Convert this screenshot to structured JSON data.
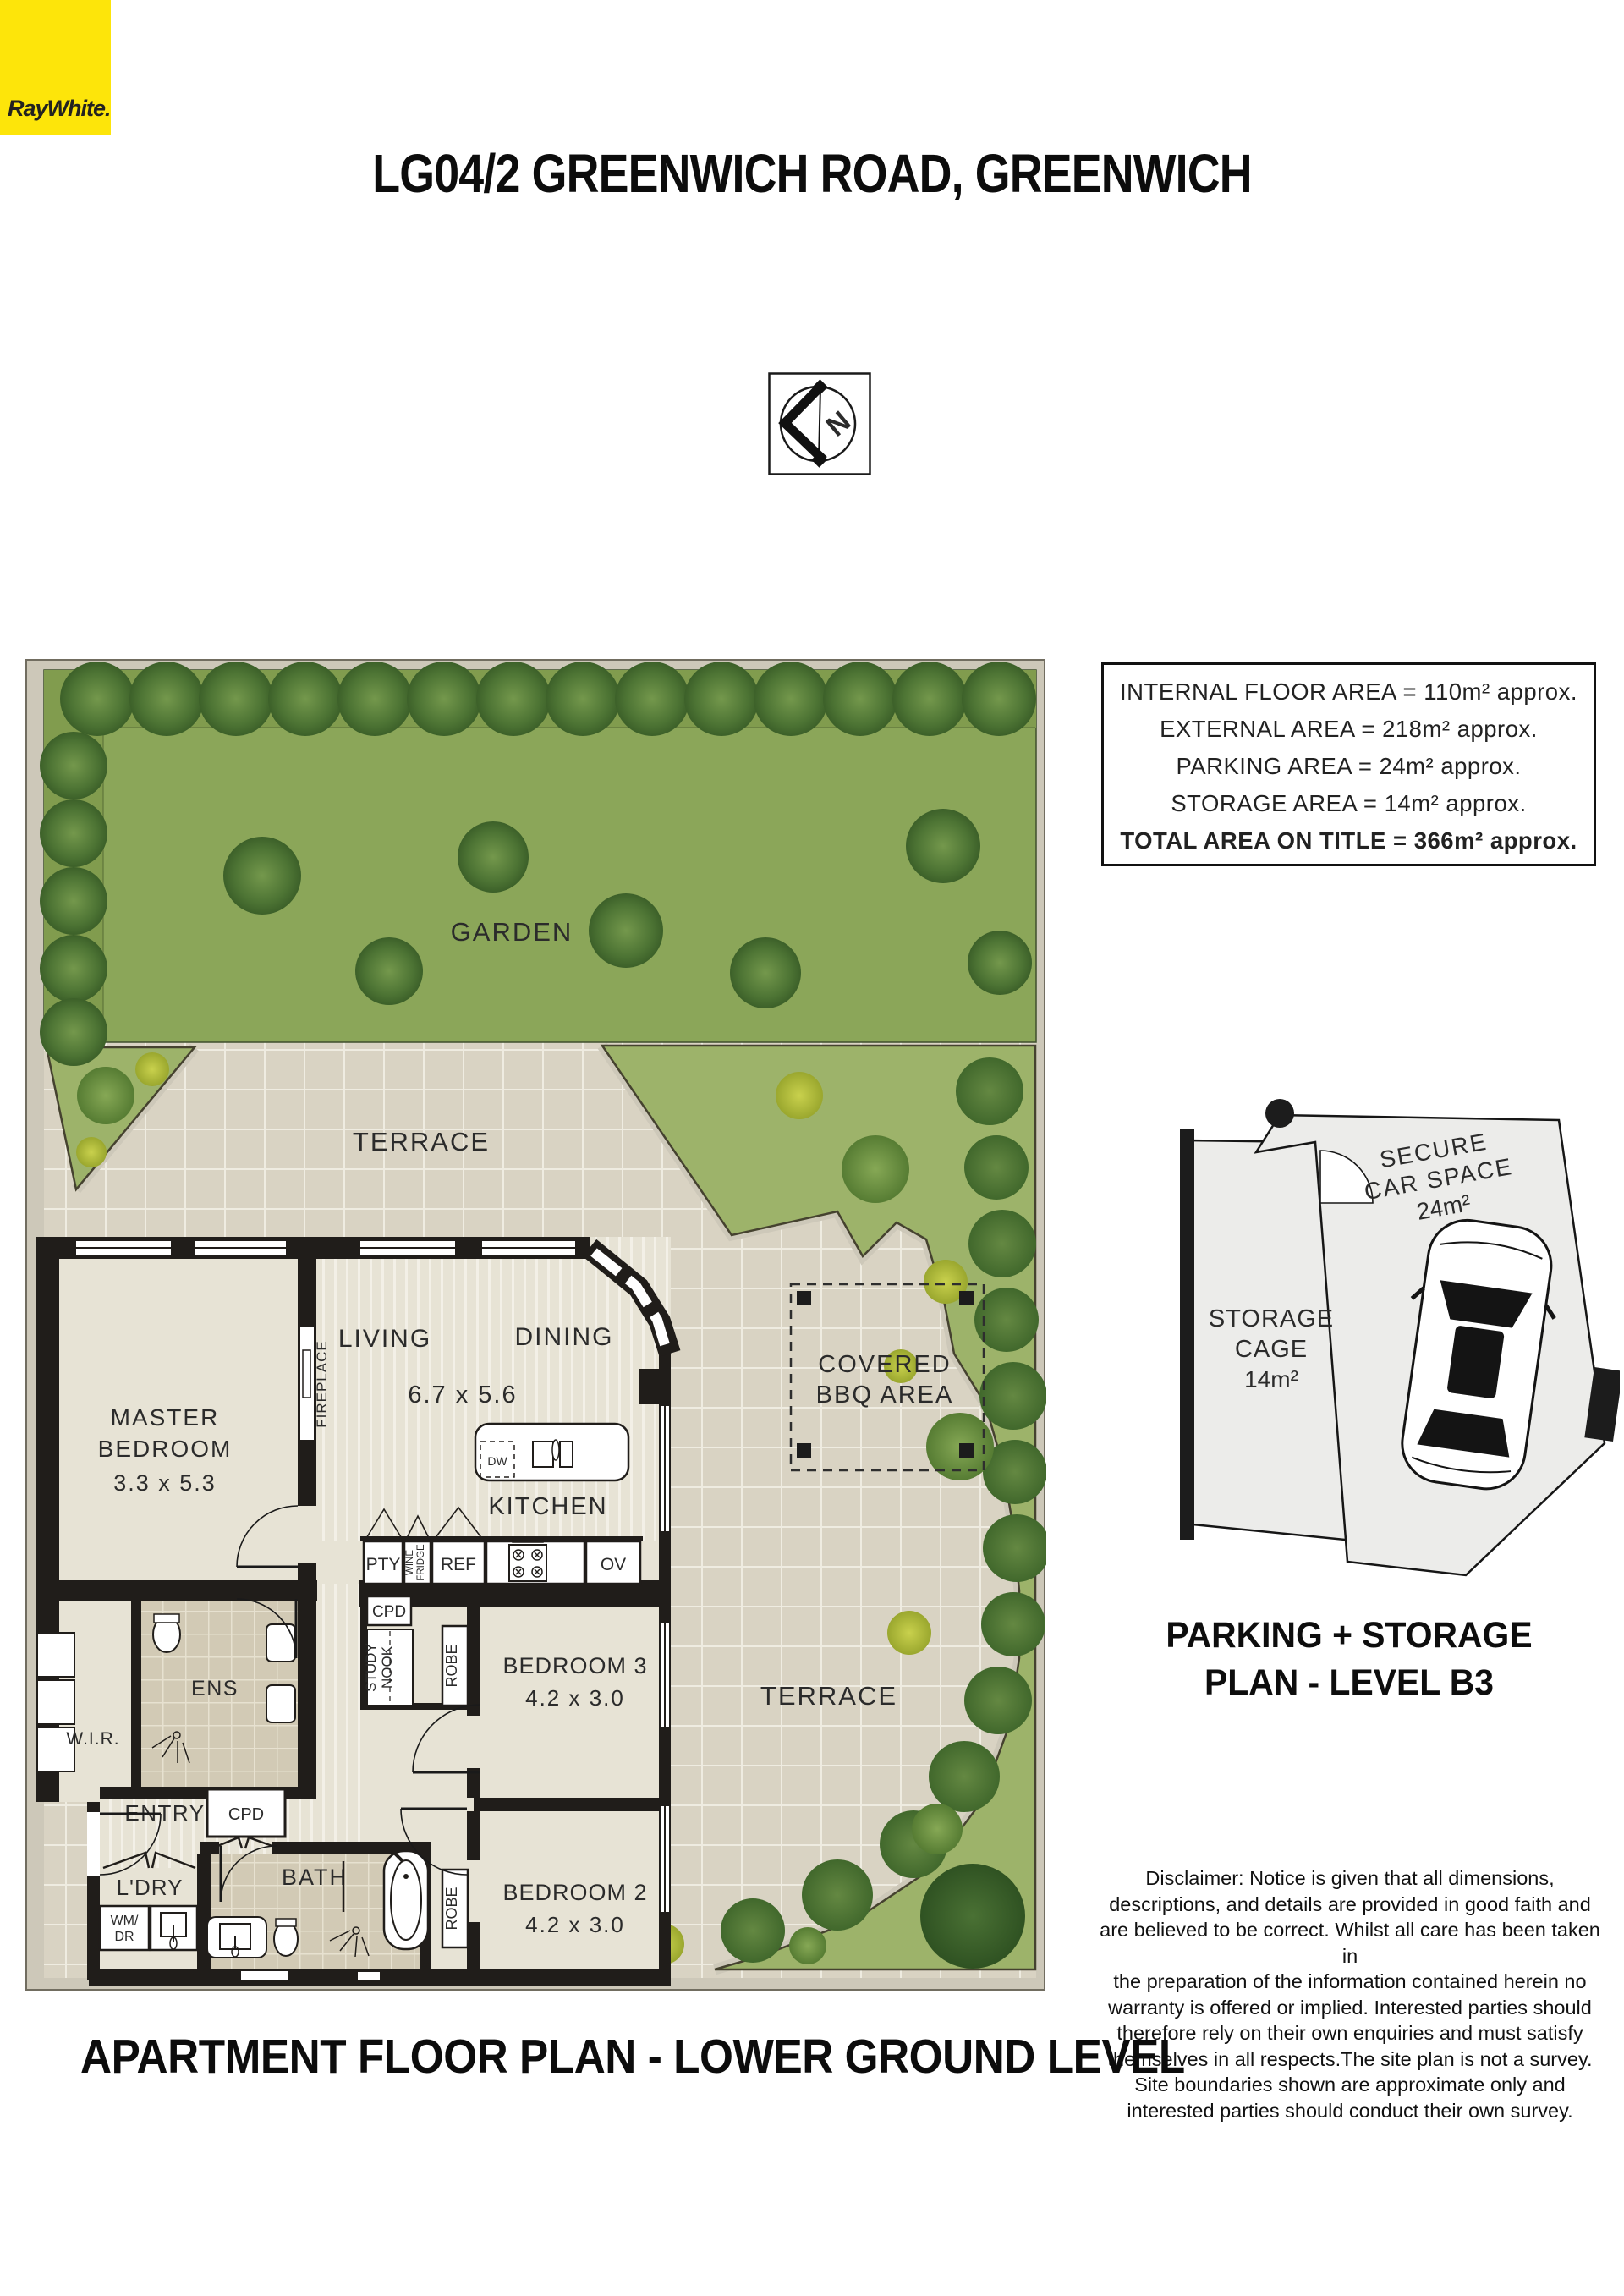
{
  "page": {
    "title": "LG04/2 GREENWICH ROAD, GREENWICH",
    "caption": "APARTMENT FLOOR PLAN - LOWER GROUND LEVEL"
  },
  "logo": {
    "text": "RayWhite.",
    "bg_color": "#FDE50A"
  },
  "compass": {
    "letter": "N"
  },
  "area_summary": {
    "lines": [
      "INTERNAL FLOOR AREA = 110m² approx.",
      "EXTERNAL AREA = 218m² approx.",
      "PARKING  AREA = 24m² approx.",
      "STORAGE  AREA = 14m² approx.",
      "TOTAL AREA ON TITLE = 366m² approx."
    ]
  },
  "floor_plan": {
    "garden": "GARDEN",
    "terrace_upper": "TERRACE",
    "terrace_lower": "TERRACE",
    "bbq": {
      "l1": "COVERED",
      "l2": "BBQ AREA"
    },
    "master": {
      "l1": "MASTER",
      "l2": "BEDROOM",
      "dims": "3.3 x 5.3"
    },
    "fireplace": "FIREPLACE",
    "living": "LIVING",
    "dining": "DINING",
    "living_dims": "6.7 x 5.6",
    "kitchen": "KITCHEN",
    "dw": "DW",
    "pty": "PTY",
    "wine": {
      "l1": "WINE",
      "l2": "FRIDGE"
    },
    "ref": "REF",
    "ov": "OV",
    "cpd_kitchen": "CPD",
    "cpd_entry": "CPD",
    "study": {
      "l1": "STUDY",
      "l2": "NOOK"
    },
    "robe_bed3": "ROBE",
    "robe_bed2": "ROBE",
    "bed3": {
      "name": "BEDROOM 3",
      "dims": "4.2 x 3.0"
    },
    "bed2": {
      "name": "BEDROOM 2",
      "dims": "4.2 x 3.0"
    },
    "wir": "W.I.R.",
    "ens": "ENS",
    "entry": "ENTRY",
    "ldry": "L'DRY",
    "wm": {
      "l1": "WM/",
      "l2": "DR"
    },
    "bath": "BATH"
  },
  "parking_plan": {
    "car_space": {
      "l1": "SECURE",
      "l2": "CAR SPACE",
      "l3": "24m²"
    },
    "storage": {
      "l1": "STORAGE",
      "l2": "CAGE",
      "l3": "14m²"
    },
    "heading": "PARKING + STORAGE\nPLAN - LEVEL B3"
  },
  "disclaimer": "Disclaimer: Notice is given that all dimensions,\ndescriptions, and details are provided in good faith and\nare believed to be correct. Whilst all care has been taken in\nthe preparation of the information contained herein no\nwarranty is offered or implied. Interested parties should\ntherefore rely on their own enquiries and must satisfy\nthemselves in all respects.The site plan is not a survey.\nSite boundaries shown are approximate only and\ninterested parties should conduct their own survey.",
  "colors": {
    "logo_yellow": "#FDE50A",
    "lawn_green": "#8ba659",
    "strip_green": "#9db36a",
    "terrace_beige": "#d9d3c3",
    "wall_black": "#201d1a"
  }
}
